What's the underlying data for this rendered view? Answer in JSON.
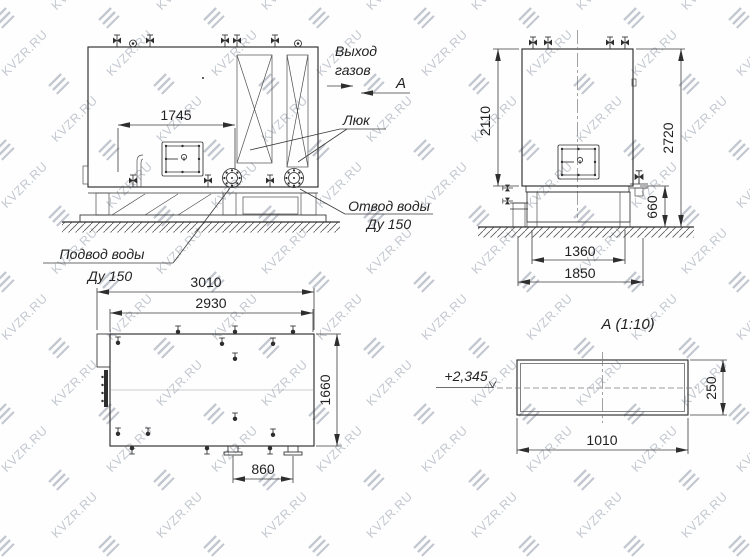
{
  "colors": {
    "line": "#2e2e2e",
    "watermark": "#b9bfc8"
  },
  "watermark": {
    "text": "KVZR.RU"
  },
  "views": {
    "front": {
      "dims": {
        "width_top": "1745"
      },
      "labels": {
        "gas_outlet": [
          "Выход",
          "газов"
        ],
        "section_arrow": "А",
        "hatch": "Люк",
        "water_outlet": [
          "Отвод воды",
          "Ду 150"
        ],
        "water_inlet": [
          "Подвод воды",
          "Ду 150"
        ]
      }
    },
    "side": {
      "dims": {
        "body_height": "2110",
        "total_height": "2720",
        "frame_height": "660",
        "frame_width": "1360",
        "base_width": "1850"
      }
    },
    "plan": {
      "dims": {
        "length_overall": "3010",
        "length_body": "2930",
        "width": "1660",
        "nozzle_spacing": "860"
      }
    },
    "section": {
      "title": "А  (1:10)",
      "level": "+2,345",
      "dims": {
        "width": "1010",
        "height": "250"
      }
    }
  }
}
